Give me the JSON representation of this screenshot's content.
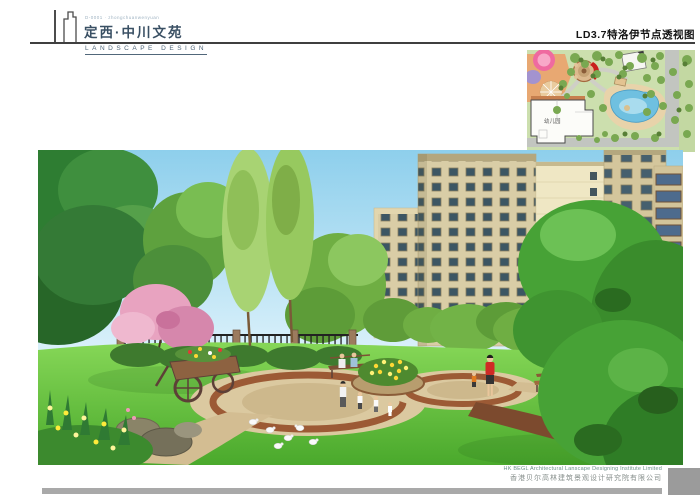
{
  "header": {
    "logo_caption": "D-0001 · zhongchuanwenyuan",
    "project_title": "定西·中川文苑",
    "subtitle": "LANDSCAPE DESIGN",
    "sheet_title": "LD3.7特洛伊节点透视图"
  },
  "site_plan": {
    "building_label": "幼儿园",
    "marker_color": "#c9201d"
  },
  "scene": {
    "description": "Perspective rendering of the Troy node: circular paved plaza with central yellow flower bed, lawns, iron fence with brick piers, flowering and evergreen trees, wooden cart planter, benches, strolling figures, white pigeons, and beige residential towers behind."
  },
  "footer": {
    "company_en": "HK BEGL Architectural Lanscape Designing Institute Limited",
    "company_cn": "香港贝尔高林建筑景观设计研究院有限公司"
  },
  "colors": {
    "title_blue": "#3a5064",
    "rule_gray": "#3f3f3f",
    "sky_blue": "#9ed8f0",
    "lawn_green": "#4aa92c",
    "plaza_tan": "#dbc9a0",
    "ring_brown": "#9c5a35",
    "footer_bar_gray": "#a9a9a9"
  }
}
